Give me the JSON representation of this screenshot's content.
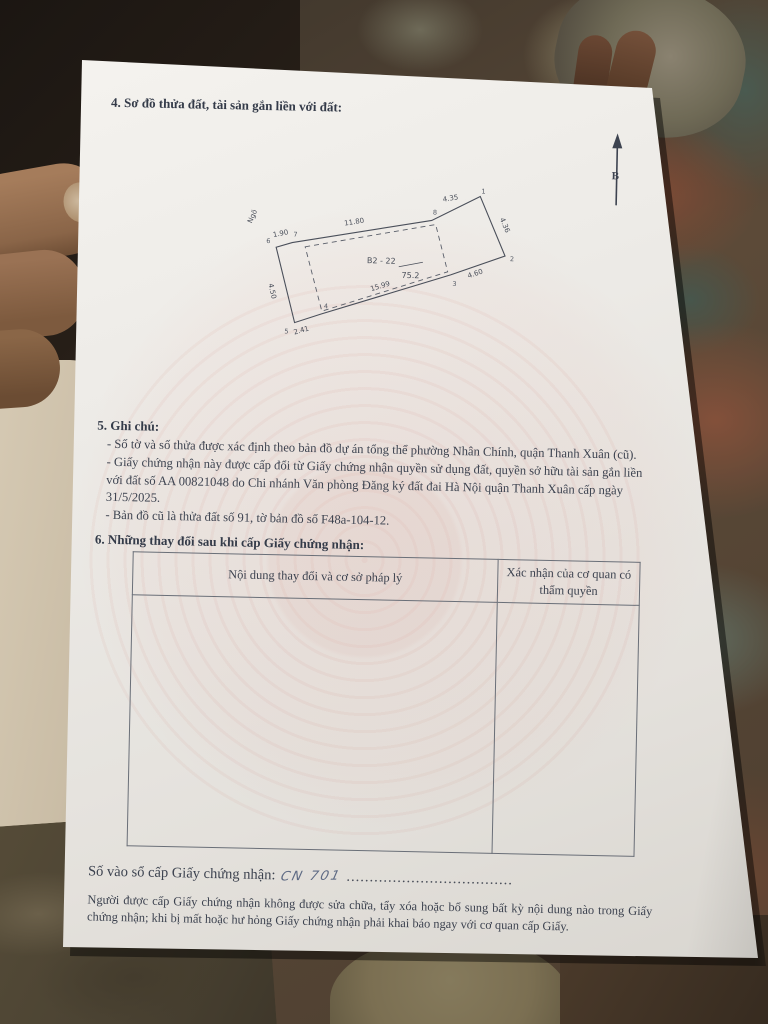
{
  "colors": {
    "paper": "#ece9e4",
    "ink": "#3d4350",
    "watermark_pink": "#cd7366",
    "handwriting_blue": "#5e6a84",
    "floor_rust": "#7e4a35",
    "floor_teal": "#5f6b5f"
  },
  "document": {
    "section4_heading": "4. Sơ đồ thửa đất, tài sản gắn liền với đất:",
    "north_label": "B",
    "diagram": {
      "street_label": "Ngõ",
      "plot_code": "B2 - 22",
      "area": "75.2",
      "edge_top_left": "1.90",
      "edge_top": "11.80",
      "edge_top_right": "4.35",
      "edge_right": "4.36",
      "edge_right_lower": "4.60",
      "edge_bottom": "15.99",
      "edge_bottom_left": "2.41",
      "edge_left": "4.50",
      "vertices": {
        "v1": "1",
        "v2": "2",
        "v3": "3",
        "v4": "4",
        "v5": "5",
        "v6": "6",
        "v7": "7",
        "v8": "8"
      }
    },
    "section5": {
      "heading": "5. Ghi chú:",
      "notes": [
        "- Số tờ và số thửa được xác định theo bản đồ dự án tổng thể phường Nhân Chính, quận Thanh Xuân (cũ).",
        "- Giấy chứng nhận này được cấp đổi từ Giấy chứng nhận quyền sử dụng đất, quyền sở hữu tài sản gắn liền với đất số AA 00821048 do Chi nhánh Văn phòng Đăng ký đất đai Hà Nội quận Thanh Xuân cấp ngày 31/5/2025.",
        "- Bản đồ cũ là thửa đất số 91, tờ bản đồ số F48a-104-12."
      ]
    },
    "section6": {
      "heading": "6. Những thay đổi sau khi cấp Giấy chứng nhận:",
      "table": {
        "col1_header": "Nội dung thay đổi và cơ sở pháp lý",
        "col2_header": "Xác nhận của cơ quan có thẩm quyền"
      }
    },
    "footer": {
      "serial_label": "Số vào sổ cấp Giấy chứng nhận:",
      "serial_value": "CN 701",
      "dots": "....................................",
      "notice": "Người được cấp Giấy chứng nhận không được sửa chữa, tẩy xóa hoặc bổ sung bất kỳ nội dung nào trong Giấy chứng nhận; khi bị mất hoặc hư hỏng Giấy chứng nhận phải khai báo ngay với cơ quan cấp Giấy."
    }
  }
}
